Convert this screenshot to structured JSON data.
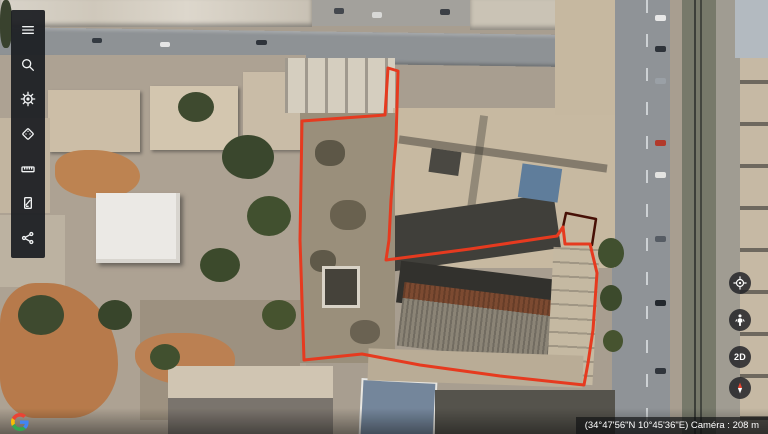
{
  "app": {
    "title": "Google Earth"
  },
  "toolbar": {
    "items": [
      {
        "icon": "menu-icon"
      },
      {
        "icon": "search-icon"
      },
      {
        "icon": "voyager-ship-wheel-icon"
      },
      {
        "icon": "feeling-lucky-dice-icon"
      },
      {
        "icon": "measure-ruler-icon"
      },
      {
        "icon": "map-style-icon"
      },
      {
        "icon": "share-icon"
      }
    ]
  },
  "map_controls": {
    "buttons": [
      {
        "icon": "my-location-icon",
        "label": ""
      },
      {
        "icon": "pegman-icon",
        "label": ""
      },
      {
        "icon": "2d-toggle",
        "label": "2D"
      },
      {
        "icon": "compass-icon",
        "label": ""
      }
    ]
  },
  "google_logo": {
    "letter": "G"
  },
  "status_bar": {
    "text": "(34°47'56\"N 10°45'36\"E) Caméra : 208 m"
  },
  "colors": {
    "measure_line": "#e63a1f",
    "measure_line_dark": "#471006",
    "toolbar_bg": "#1d1f23",
    "compass_north": "#e8432f"
  },
  "measurement_overlay": {
    "stroke_width": 3,
    "polygon_px": [
      [
        398,
        71
      ],
      [
        396,
        140
      ],
      [
        391,
        200
      ],
      [
        389,
        240
      ],
      [
        386,
        260
      ],
      [
        470,
        249
      ],
      [
        557,
        236
      ],
      [
        563,
        227
      ],
      [
        565,
        244
      ],
      [
        590,
        244
      ],
      [
        597,
        273
      ],
      [
        593,
        330
      ],
      [
        588,
        363
      ],
      [
        584,
        385
      ],
      [
        500,
        376
      ],
      [
        420,
        365
      ],
      [
        362,
        354
      ],
      [
        304,
        360
      ],
      [
        300,
        240
      ],
      [
        302,
        121
      ],
      [
        385,
        115
      ],
      [
        388,
        68
      ]
    ],
    "notch_px": [
      [
        563,
        227
      ],
      [
        566,
        213
      ],
      [
        596,
        219
      ],
      [
        592,
        245
      ]
    ]
  }
}
